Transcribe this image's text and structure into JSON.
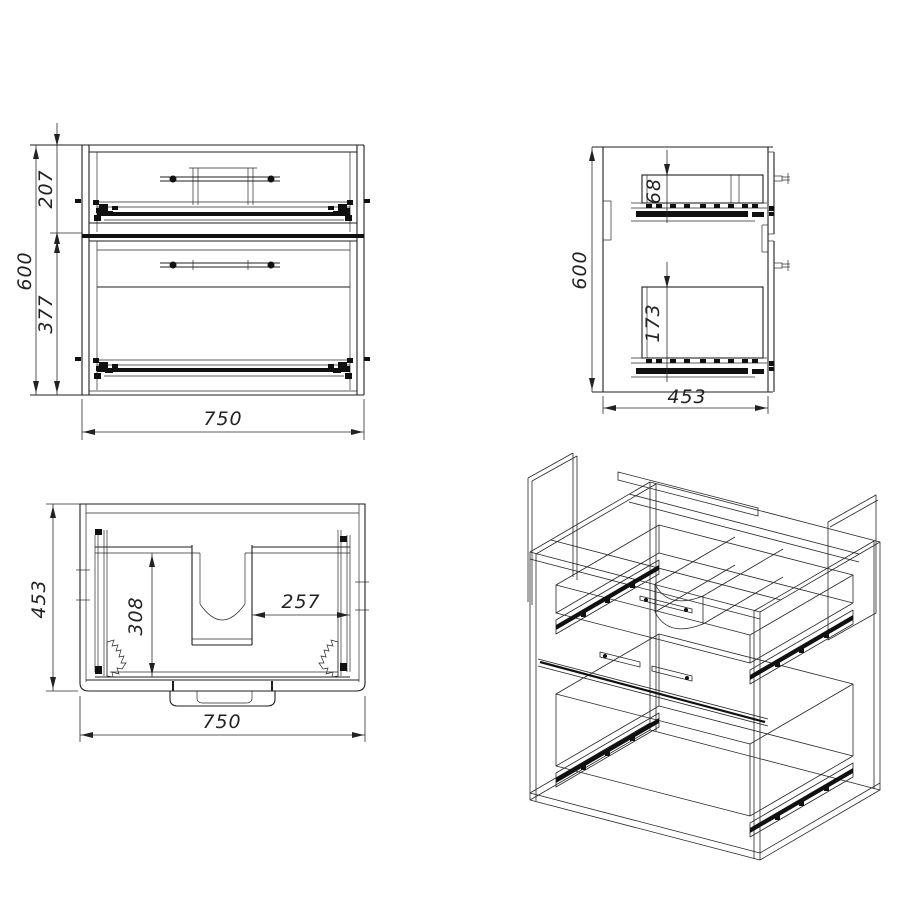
{
  "drawing": {
    "views": {
      "front": {
        "name": "front view",
        "dims": {
          "total_height": "600",
          "top_section": "207",
          "bottom_section": "377",
          "width": "750"
        }
      },
      "side": {
        "name": "side view",
        "dims": {
          "height": "600",
          "top_drawer_box": "68",
          "bottom_drawer_box": "173",
          "depth": "453"
        }
      },
      "top": {
        "name": "top view",
        "dims": {
          "depth": "453",
          "inner_depth": "308",
          "cutout_offset": "257",
          "width": "750"
        }
      },
      "isometric": {
        "name": "isometric wireframe view"
      }
    },
    "colors": {
      "line": "#1f1f1f",
      "background": "#ffffff"
    }
  }
}
